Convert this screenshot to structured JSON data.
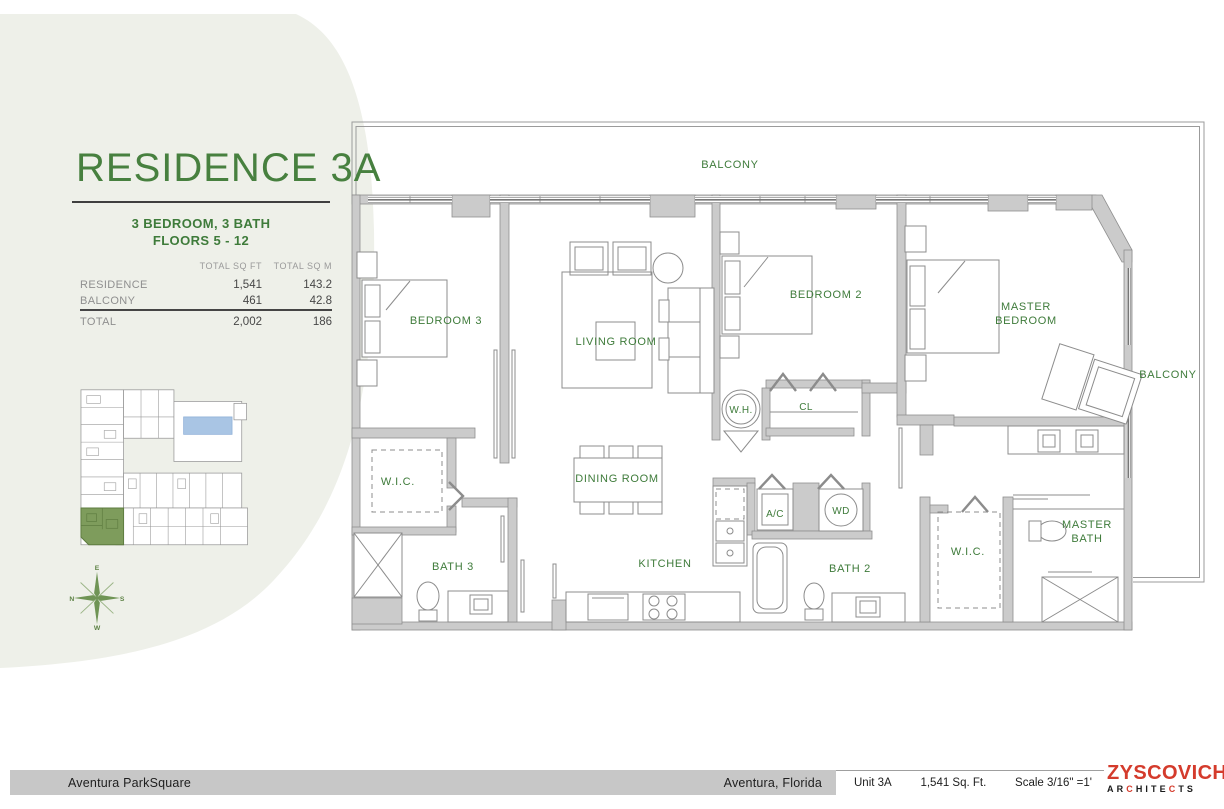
{
  "colors": {
    "accent_green": "#47803f",
    "label_green": "#3e7b3a",
    "wall_gray": "#cbcbcb",
    "pool_blue": "#a9c5e4",
    "keyplan_unit_green": "#7e9c5c",
    "logo_red": "#d43b2c",
    "footer_bar_gray": "#c7c7c7",
    "sidebar_blob": "#eef0e9"
  },
  "sidebar": {
    "title": "RESIDENCE 3A",
    "subtitle_line1": "3 BEDROOM, 3 BATH",
    "subtitle_line2": "FLOORS 5 - 12",
    "table": {
      "header_sqft": "TOTAL SQ FT",
      "header_sqm": "TOTAL SQ M",
      "rows": [
        {
          "label": "RESIDENCE",
          "sqft": "1,541",
          "sqm": "143.2"
        },
        {
          "label": "BALCONY",
          "sqft": "461",
          "sqm": "42.8"
        },
        {
          "label": "TOTAL",
          "sqft": "2,002",
          "sqm": "186"
        }
      ]
    },
    "compass": {
      "top": "E",
      "left": "N",
      "right": "S",
      "bottom": "W"
    }
  },
  "plan": {
    "labels": {
      "balcony_top": "BALCONY",
      "balcony_right": "BALCONY",
      "bedroom3": "BEDROOM 3",
      "living_room": "LIVING ROOM",
      "bedroom2": "BEDROOM 2",
      "master_line1": "MASTER",
      "master_line2": "BEDROOM",
      "water_heater": "W.H.",
      "closet": "CL",
      "wic_left": "W.I.C.",
      "dining_room": "DINING ROOM",
      "bath3": "BATH 3",
      "kitchen": "KITCHEN",
      "ac": "A/C",
      "wd": "WD",
      "bath2": "BATH 2",
      "wic_master": "W.I.C.",
      "master_bath_line1": "MASTER",
      "master_bath_line2": "BATH"
    }
  },
  "footer": {
    "project": "Aventura ParkSquare",
    "location": "Aventura, Florida",
    "unit": "Unit 3A",
    "area": "1,541 Sq. Ft.",
    "scale": "Scale 3/16\" =1'",
    "logo_name": "ZYSCOVICH",
    "logo_sub_parts": [
      "AR",
      "C",
      "HITE",
      "C",
      "TS"
    ]
  }
}
